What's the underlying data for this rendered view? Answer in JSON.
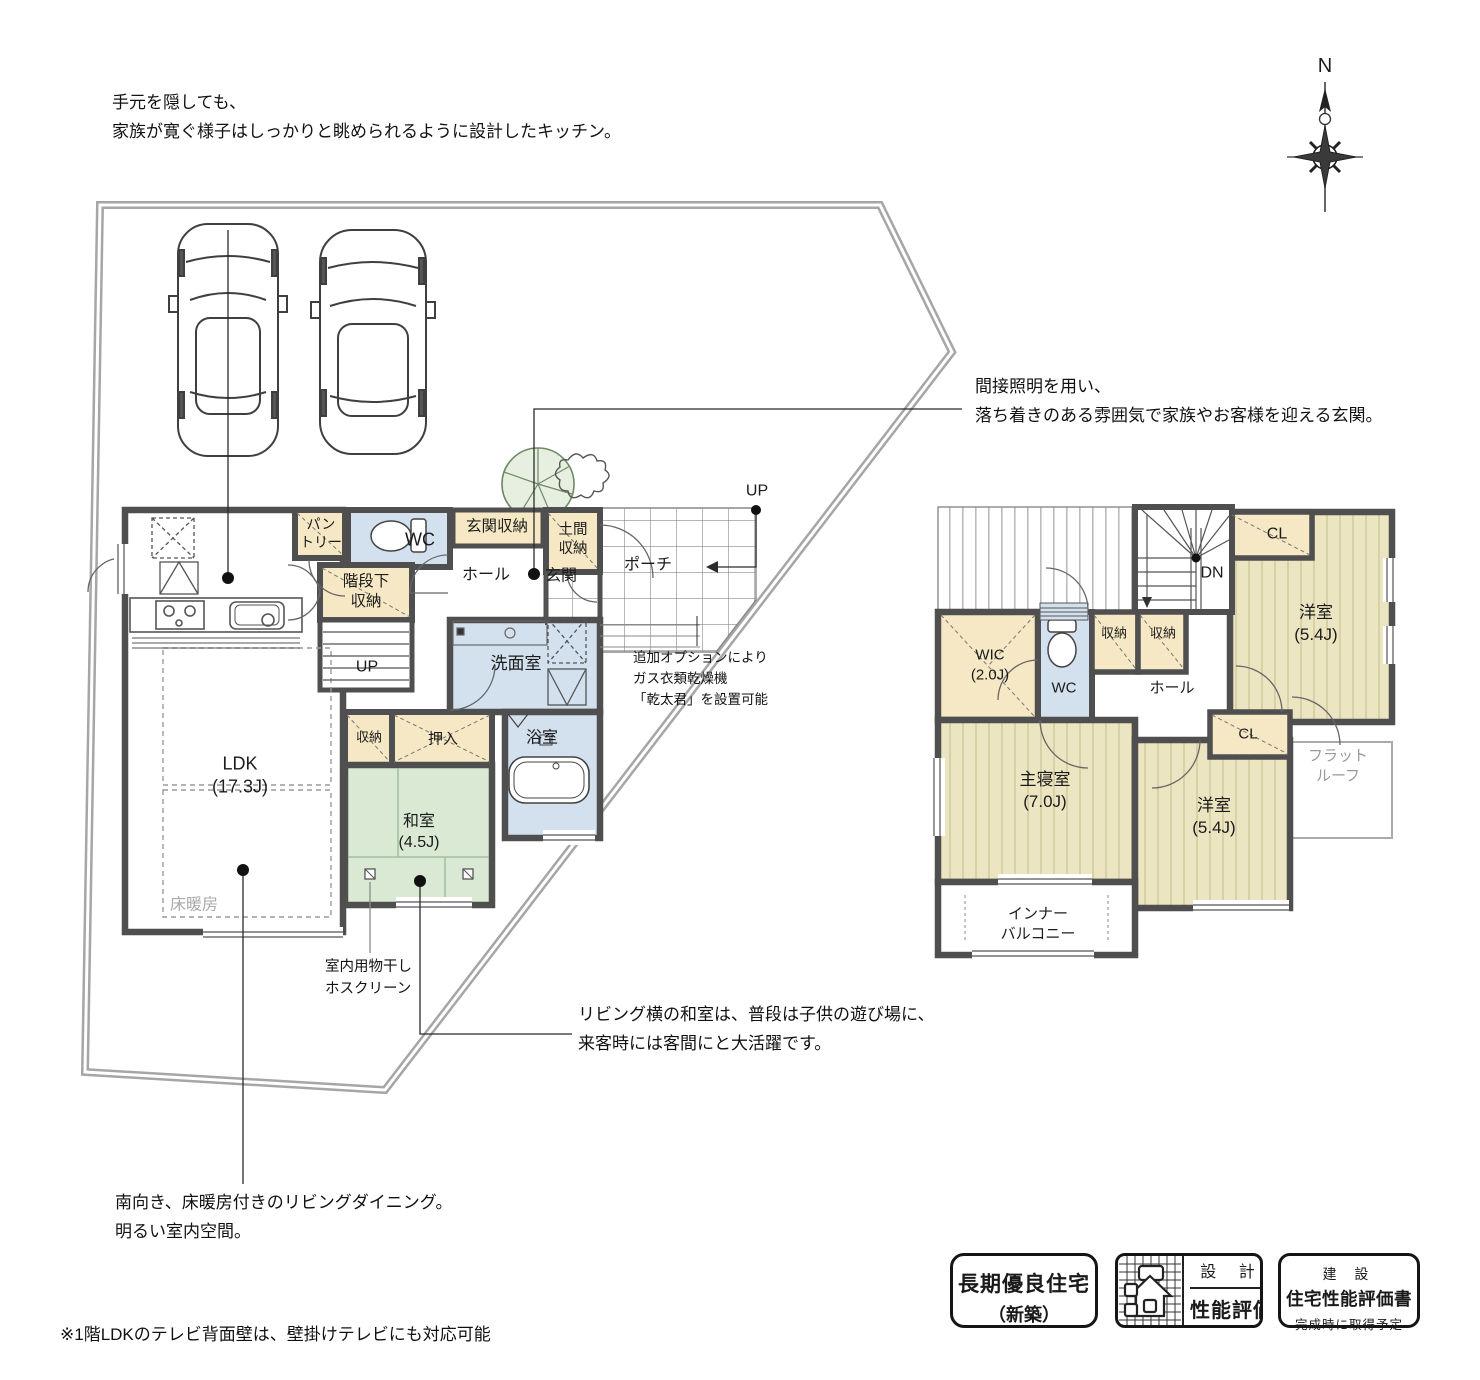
{
  "compass": {
    "north": "N"
  },
  "annotations": {
    "kitchen": "手元を隠しても、\n家族が寛ぐ様子はしっかりと眺められるように設計したキッチン。",
    "entrance": "間接照明を用い、\n落ち着きのある雰囲気で家族やお客様を迎える玄関。",
    "dryer": "追加オプションにより\nガス衣類乾燥機\n「乾太君」を設置可能",
    "hoscreen": "室内用物干し\nホスクリーン",
    "tatami_room": "リビング横の和室は、普段は子供の遊び場に、\n来客時には客間にと大活躍です。",
    "south": "南向き、床暖房付きのリビングダイニング。\n明るい室内空間。",
    "footnote": "※1階LDKのテレビ背面壁は、壁掛けテレビにも対応可能"
  },
  "floor1": {
    "ldk": "LDK\n(17.3J)",
    "yukadanbo": "床暖房",
    "washitsu": "和室\n(4.5J)",
    "oshiire": "押入",
    "shuno": "収納",
    "senmenshitsu": "洗面室",
    "yokushitsu": "浴室",
    "wc": "WC",
    "pantry": "パン\nトリー",
    "kaidanshita_shuno": "階段下\n収納",
    "genkan_shuno": "玄関収納",
    "doma_shuno": "土間\n収納",
    "hall": "ホール",
    "genkan": "玄関",
    "porch": "ポーチ",
    "up_stairs": "UP",
    "up_porch": "UP"
  },
  "floor2": {
    "dn": "DN",
    "cl_ne": "CL",
    "yoshitsu_ne": "洋室\n(5.4J)",
    "wic": "WIC\n(2.0J)",
    "wc": "WC",
    "shuno_a": "収納",
    "shuno_b": "収納",
    "hall": "ホール",
    "cl_s": "CL",
    "shushinshitsu": "主寝室\n(7.0J)",
    "yoshitsu_se": "洋室\n(5.4J)",
    "flat_roof": "フラット\nルーフ",
    "inner_balcony": "インナー\nバルコニー"
  },
  "badges": {
    "choki": {
      "line1": "長期優良住宅",
      "line2": "（新築）"
    },
    "sekkei": {
      "top": "設 計",
      "bottom": "性能評価"
    },
    "kensetsu": {
      "top": "建 設",
      "middle": "住宅性能評価書",
      "bottom": "完成時に取得予定"
    }
  },
  "colors": {
    "wall": "#4f4f4f",
    "storage": "#f6e8c4",
    "wet_area": "#d3e1ef",
    "tatami_1f": "#d9e9d3",
    "room_2f": "#ece5c2",
    "room_2f_stripe": "#d8d1a6",
    "site_boundary": "#a6a6a6"
  }
}
